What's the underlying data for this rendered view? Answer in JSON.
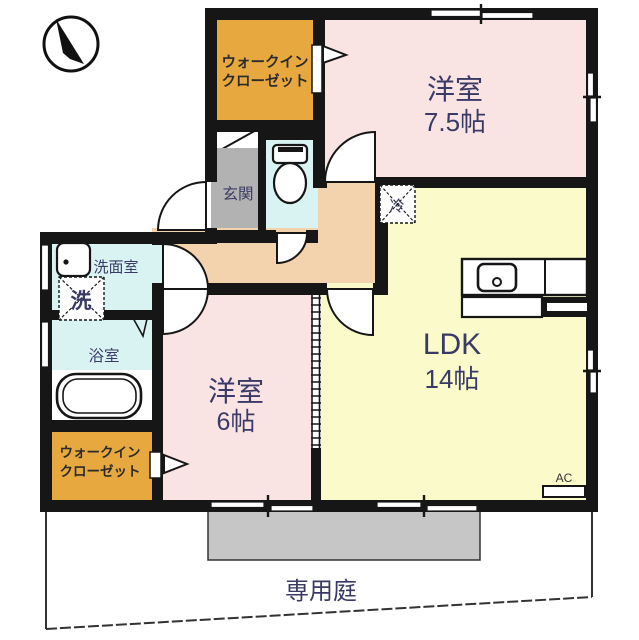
{
  "plan_type": "apartment-floor-plan",
  "labels": {
    "wic_line1": "ウォークイン",
    "wic_line2": "クローゼット",
    "western_room": "洋室",
    "western_75_size": "7.5帖",
    "western_6_size": "6帖",
    "ldk": "LDK",
    "ldk_size": "14帖",
    "genkan": "玄関",
    "washroom": "洗面室",
    "bathroom": "浴室",
    "washer": "洗",
    "fridge": "冷",
    "ac": "AC",
    "garden": "専用庭"
  },
  "colors": {
    "wall": "#161616",
    "closet_orange": "#E7A93F",
    "room_pink": "#FAE3E3",
    "ldk_yellow": "#FAFACB",
    "corridor_peach": "#F3D2AE",
    "wet_cyan": "#D9F3F3",
    "entry_gray": "#B2B2B2",
    "terrace_gray": "#C6C6C6",
    "label_navy": "#3A3A66"
  }
}
